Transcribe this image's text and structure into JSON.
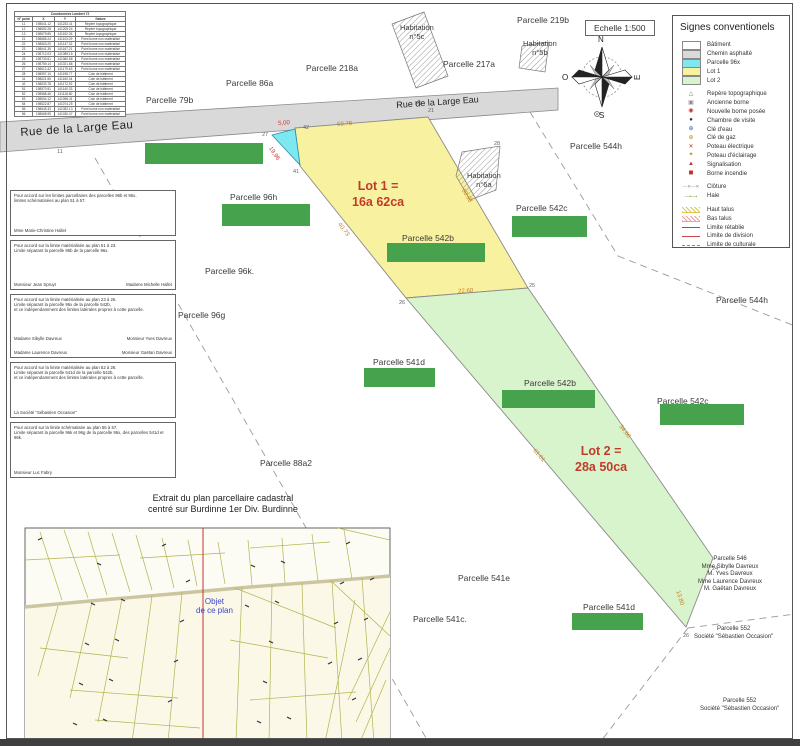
{
  "sheet": {
    "scale_label": "Echelle 1:500"
  },
  "compass": {
    "n": "N",
    "e": "E",
    "s": "S",
    "o": "O"
  },
  "colors": {
    "road": "#d9d9d9",
    "parcel_96x": "#7de8ef",
    "lot1": "#f7f1a0",
    "lot2": "#d8f4cc",
    "redaction": "#46a24c",
    "lot_text": "#c23b2a",
    "measure": "#c77d1e",
    "measure_red": "#cc3333",
    "objet_blue": "#3a46c8"
  },
  "coord_table": {
    "title": "Coordonnées Lambert 72",
    "columns": [
      "N° point",
      "X",
      "Y",
      "Nature"
    ],
    "rows": [
      [
        "11",
        "198641.12",
        "141233.41",
        "Repère topographique"
      ],
      [
        "12",
        "198652.28",
        "141205.24",
        "Repère topographique"
      ],
      [
        "13",
        "198679.89",
        "141152.05",
        "Repère topographique"
      ],
      [
        "21",
        "198685.24",
        "141103.09",
        "Point borne non matérialisé"
      ],
      [
        "22",
        "198663.20",
        "141147.32",
        "Point borne non matérialisé"
      ],
      [
        "23",
        "198641.35",
        "141167.21",
        "Point borne non matérialisé"
      ],
      [
        "24",
        "198712.03",
        "141089.15",
        "Point borne non matérialisé"
      ],
      [
        "25",
        "198733.61",
        "141060.58",
        "Point borne non matérialisé"
      ],
      [
        "26",
        "198759.14",
        "141021.86",
        "Point borne non matérialisé"
      ],
      [
        "27",
        "198612.42",
        "141179.63",
        "Point borne non matérialisé"
      ],
      [
        "28",
        "198597.10",
        "141198.77",
        "Coin de bâtiment"
      ],
      [
        "41",
        "198621.55",
        "141160.04",
        "Coin de bâtiment"
      ],
      [
        "42",
        "198633.78",
        "141172.92",
        "Coin de bâtiment"
      ],
      [
        "51",
        "198570.91",
        "141140.33",
        "Coin de bâtiment"
      ],
      [
        "52",
        "198588.46",
        "141118.60",
        "Coin de bâtiment"
      ],
      [
        "53",
        "198604.12",
        "141096.41",
        "Coin de bâtiment"
      ],
      [
        "54",
        "198622.87",
        "141074.25",
        "Coin de bâtiment"
      ],
      [
        "55",
        "198645.33",
        "141052.13",
        "Point borne non matérialisé"
      ],
      [
        "56",
        "198668.95",
        "141030.47",
        "Point borne non matérialisé"
      ]
    ]
  },
  "legend": {
    "title": "Signes conventionels",
    "items": [
      {
        "label": "Bâtiment",
        "sym": "swatch",
        "color": "#ffffff",
        "icon": "building-swatch"
      },
      {
        "label": "Chemin asphalté",
        "sym": "swatch",
        "color": "#d9d9d9",
        "icon": "road-swatch"
      },
      {
        "label": "Parcelle 96x",
        "sym": "swatch",
        "color": "#7de8ef",
        "icon": "parcel96x-swatch"
      },
      {
        "label": "Lot 1",
        "sym": "swatch",
        "color": "#f7f1a0",
        "icon": "lot1-swatch"
      },
      {
        "label": "Lot 2",
        "sym": "swatch",
        "color": "#d8f4cc",
        "icon": "lot2-swatch"
      },
      {
        "label": "Repère topographique",
        "sym": "glyph",
        "char": "△",
        "color": "#7a7a7a",
        "gap": true,
        "icon": "survey-marker-icon"
      },
      {
        "label": "Ancienne borne",
        "sym": "glyph",
        "char": "▣",
        "color": "#8a8a8a",
        "icon": "old-boundary-stone-icon"
      },
      {
        "label": "Nouvelle borne posée",
        "sym": "glyph",
        "char": "◉",
        "color": "#c03030",
        "icon": "new-boundary-stone-icon"
      },
      {
        "label": "Chambre de visite",
        "sym": "glyph",
        "char": "●",
        "color": "#333333",
        "icon": "manhole-icon"
      },
      {
        "label": "Clé d'eau",
        "sym": "glyph",
        "char": "⊕",
        "color": "#2f6fc0",
        "icon": "water-valve-icon"
      },
      {
        "label": "Clé de gaz",
        "sym": "glyph",
        "char": "⊕",
        "color": "#d08a20",
        "icon": "gas-valve-icon"
      },
      {
        "label": "Poteau électrique",
        "sym": "glyph",
        "char": "✕",
        "color": "#c03030",
        "icon": "power-pole-icon"
      },
      {
        "label": "Poteau d'éclairage",
        "sym": "glyph",
        "char": "✦",
        "color": "#d08a20",
        "icon": "street-light-icon"
      },
      {
        "label": "Signalisation",
        "sym": "glyph",
        "char": "▲",
        "color": "#c03030",
        "icon": "signage-icon"
      },
      {
        "label": "Borne incendie",
        "sym": "glyph",
        "char": "◼",
        "color": "#c03030",
        "icon": "fire-hydrant-icon"
      },
      {
        "label": "Clôture",
        "sym": "xline",
        "color": "#888888",
        "gap": true,
        "icon": "fence-line-icon"
      },
      {
        "label": "Haie",
        "sym": "haie",
        "color": "#6a9a3a",
        "icon": "hedge-line-icon"
      },
      {
        "label": "Haut talus",
        "sym": "band",
        "color": "#d9c84a",
        "gap": true,
        "icon": "upper-slope-icon"
      },
      {
        "label": "Bas talus",
        "sym": "band",
        "color": "#e8a0a0",
        "icon": "lower-slope-icon"
      },
      {
        "label": "Limite rétablie",
        "sym": "line",
        "color": "#4466cc",
        "icon": "restored-limit-line"
      },
      {
        "label": "Limite de division",
        "sym": "line",
        "color": "#cc4444",
        "icon": "division-limit-line"
      },
      {
        "label": "Limite de culturale",
        "sym": "dashdot",
        "color": "#888888",
        "icon": "cultural-limit-line"
      }
    ]
  },
  "accord_blocks": [
    {
      "h": 46,
      "lines": [
        "Pour accord sur les limites parcellaires des parcelles 96b et 96x,",
        "limites schématisées au plan 51 à 57."
      ],
      "sigs": [
        [
          "Mme Marie-Christine Hallet"
        ]
      ]
    },
    {
      "h": 50,
      "lines": [
        "Pour accord sur la limite matérialisée au plan 51 à 23.",
        "Limite séparant la parcelle 96b de la parcelle 96x."
      ],
      "sigs": [
        [
          "Monsieur Jean Spruyt",
          "Madame Michelle Hallet"
        ]
      ]
    },
    {
      "h": 64,
      "lines": [
        "Pour accord sur la limite matérialisée au plan 23 à 26.",
        "Limite séparant la parcelle 96x de la parcelle 542b,",
        "et ce indépendamment des limites latérales propres à cette parcelle."
      ],
      "sigs": [
        [
          "Madame Sibylle Davreux",
          "Monsieur Yves Davreux"
        ],
        [
          "Madame Laurence Davreux",
          "Monsieur Gaëtan Davreux"
        ]
      ]
    },
    {
      "h": 56,
      "lines": [
        "Pour accord sur la limite matérialisée au plan 52 à 26.",
        "Limite séparant la parcelle 541d de la parcelle 542b,",
        "et ce indépendamment des limites latérales propres à cette parcelle."
      ],
      "sigs": [
        [
          "La Société \"Sébastien Occasion\""
        ]
      ]
    },
    {
      "h": 56,
      "lines": [
        "Pour accord sur la limite schématisée au plan 55 à 57.",
        "Limite séparant la parcelle 96k et 96g de la parcelle 96x, des parcelles 541d et 96k."
      ],
      "sigs": [
        [
          "Monsieur Luc Fabry"
        ]
      ]
    }
  ],
  "map": {
    "labels": [
      {
        "name": "road-name-left",
        "cls": "road-lg",
        "x": 20,
        "y": 127,
        "rot": -4,
        "lines": [
          "Rue de la Large Eau"
        ]
      },
      {
        "name": "road-name-upper",
        "cls": "road-sm",
        "x": 396,
        "y": 100,
        "rot": -4,
        "lines": [
          "Rue de la Large Eau"
        ]
      },
      {
        "name": "parcelle-86a",
        "cls": "parcel",
        "x": 226,
        "y": 78,
        "lines": [
          "Parcelle 86a"
        ]
      },
      {
        "name": "parcelle-218a",
        "cls": "parcel",
        "x": 306,
        "y": 63,
        "lines": [
          "Parcelle 218a"
        ]
      },
      {
        "name": "parcelle-79b",
        "cls": "parcel",
        "x": 146,
        "y": 95,
        "lines": [
          "Parcelle 79b"
        ]
      },
      {
        "name": "parcelle-217a",
        "cls": "parcel",
        "x": 443,
        "y": 59,
        "lines": [
          "Parcelle 217a"
        ]
      },
      {
        "name": "parcelle-219b",
        "cls": "parcel",
        "x": 517,
        "y": 15,
        "lines": [
          "Parcelle 219b"
        ]
      },
      {
        "name": "habitation-5c",
        "cls": "hab",
        "x": 400,
        "y": 24,
        "lines": [
          "Habitation",
          "n°5c"
        ]
      },
      {
        "name": "habitation-5b",
        "cls": "hab",
        "x": 523,
        "y": 40,
        "lines": [
          "Habitation",
          "n°5b"
        ]
      },
      {
        "name": "habitation-6a",
        "cls": "hab",
        "x": 467,
        "y": 172,
        "lines": [
          "Habitation",
          "n°6a"
        ]
      },
      {
        "name": "parcelle-544h-upper",
        "cls": "parcel",
        "x": 570,
        "y": 141,
        "lines": [
          "Parcelle 544h"
        ]
      },
      {
        "name": "parcelle-544h-right",
        "cls": "parcel",
        "x": 716,
        "y": 295,
        "lines": [
          "Parcelle 544h"
        ]
      },
      {
        "name": "parcelle-96h",
        "cls": "parcel",
        "x": 230,
        "y": 192,
        "lines": [
          "Parcelle 96h"
        ]
      },
      {
        "name": "parcelle-542c-upper",
        "cls": "parcel",
        "x": 516,
        "y": 203,
        "lines": [
          "Parcelle 542c"
        ]
      },
      {
        "name": "parcelle-96k",
        "cls": "parcel",
        "x": 205,
        "y": 266,
        "lines": [
          "Parcelle 96k."
        ]
      },
      {
        "name": "parcelle-96g",
        "cls": "parcel",
        "x": 178,
        "y": 310,
        "lines": [
          "Parcelle 96g"
        ]
      },
      {
        "name": "parcelle-542b-lot1",
        "cls": "parcel",
        "x": 402,
        "y": 233,
        "lines": [
          "Parcelle 542b"
        ]
      },
      {
        "name": "lot1-label",
        "cls": "lot",
        "x": 352,
        "y": 178,
        "lines": [
          "Lot 1 =",
          "16a 62ca"
        ]
      },
      {
        "name": "lot2-label",
        "cls": "lot",
        "x": 575,
        "y": 443,
        "lines": [
          "Lot 2 =",
          "28a 50ca"
        ]
      },
      {
        "name": "parcelle-541d-mid",
        "cls": "parcel",
        "x": 373,
        "y": 357,
        "lines": [
          "Parcelle 541d"
        ]
      },
      {
        "name": "parcelle-542b-lot2",
        "cls": "parcel",
        "x": 524,
        "y": 378,
        "lines": [
          "Parcelle 542b"
        ]
      },
      {
        "name": "parcelle-542c-right",
        "cls": "parcel",
        "x": 657,
        "y": 396,
        "lines": [
          "Parcelle 542c"
        ]
      },
      {
        "name": "parcelle-88a2",
        "cls": "parcel",
        "x": 260,
        "y": 458,
        "lines": [
          "Parcelle 88a2"
        ]
      },
      {
        "name": "extrait-caption",
        "cls": "caption",
        "x": 148,
        "y": 493,
        "lines": [
          "Extrait du plan parcellaire cadastral",
          "centré sur Burdinne 1er Div. Burdinne"
        ]
      },
      {
        "name": "parcelle-541e",
        "cls": "parcel",
        "x": 458,
        "y": 573,
        "lines": [
          "Parcelle 541e"
        ]
      },
      {
        "name": "parcelle-541c",
        "cls": "parcel",
        "x": 413,
        "y": 614,
        "lines": [
          "Parcelle 541c."
        ]
      },
      {
        "name": "parcelle-541d-bottom",
        "cls": "parcel",
        "x": 583,
        "y": 602,
        "lines": [
          "Parcelle 541d"
        ]
      },
      {
        "name": "parcelle-546-owners",
        "cls": "owners",
        "x": 698,
        "y": 556,
        "lines": [
          "Parcelle 546",
          "Mme Sibylle Davreux",
          "M. Yves Davreux",
          "Mme Laurence Davreux",
          "M. Gaëtan Davreux"
        ]
      },
      {
        "name": "parcelle-552-owner-1",
        "cls": "owners",
        "x": 694,
        "y": 626,
        "lines": [
          "Parcelle 552",
          "Société \"Sébastien Occasion\""
        ]
      },
      {
        "name": "parcelle-552-owner-2",
        "cls": "owners",
        "x": 700,
        "y": 698,
        "lines": [
          "Parcelle 552",
          "Société \"Sébastien Occasion\""
        ]
      },
      {
        "name": "objet-plan-label",
        "cls": "objet",
        "x": 196,
        "y": 597,
        "lines": [
          "Objet",
          "de ce plan"
        ]
      }
    ],
    "measures": [
      {
        "text": "59.78",
        "x": 337,
        "y": 122,
        "rot": -4,
        "c": "orange"
      },
      {
        "text": "5,00",
        "x": 278,
        "y": 121,
        "rot": -4,
        "c": "red"
      },
      {
        "text": "19,96",
        "x": 272,
        "y": 146,
        "rot": 55,
        "c": "red"
      },
      {
        "text": "40.73",
        "x": 341,
        "y": 222,
        "rot": 53,
        "c": "orange"
      },
      {
        "text": "60.93",
        "x": 465,
        "y": 188,
        "rot": 58,
        "c": "orange"
      },
      {
        "text": "22.60",
        "x": 458,
        "y": 289,
        "rot": -4,
        "c": "orange"
      },
      {
        "text": "61.01",
        "x": 536,
        "y": 448,
        "rot": 50,
        "c": "orange"
      },
      {
        "text": "34.60",
        "x": 622,
        "y": 424,
        "rot": 52,
        "c": "orange"
      },
      {
        "text": "13.80",
        "x": 680,
        "y": 590,
        "rot": 72,
        "c": "orange"
      }
    ],
    "points": [
      {
        "text": "11",
        "x": 57,
        "y": 149
      },
      {
        "text": "27",
        "x": 262,
        "y": 132
      },
      {
        "text": "42",
        "x": 303,
        "y": 125
      },
      {
        "text": "41",
        "x": 293,
        "y": 169
      },
      {
        "text": "F1",
        "x": 415,
        "y": 101
      },
      {
        "text": "21",
        "x": 428,
        "y": 108
      },
      {
        "text": "28",
        "x": 494,
        "y": 141
      },
      {
        "text": "26",
        "x": 399,
        "y": 300
      },
      {
        "text": "25",
        "x": 529,
        "y": 283
      },
      {
        "text": "24",
        "x": 712,
        "y": 566
      },
      {
        "text": "26",
        "x": 683,
        "y": 633
      }
    ],
    "redactions": [
      {
        "x": 145,
        "y": 143,
        "w": 118,
        "h": 21
      },
      {
        "x": 222,
        "y": 204,
        "w": 88,
        "h": 22
      },
      {
        "x": 387,
        "y": 243,
        "w": 98,
        "h": 19
      },
      {
        "x": 512,
        "y": 216,
        "w": 75,
        "h": 21
      },
      {
        "x": 364,
        "y": 368,
        "w": 71,
        "h": 19
      },
      {
        "x": 502,
        "y": 390,
        "w": 93,
        "h": 18
      },
      {
        "x": 660,
        "y": 404,
        "w": 84,
        "h": 21
      },
      {
        "x": 572,
        "y": 613,
        "w": 71,
        "h": 17
      }
    ]
  }
}
